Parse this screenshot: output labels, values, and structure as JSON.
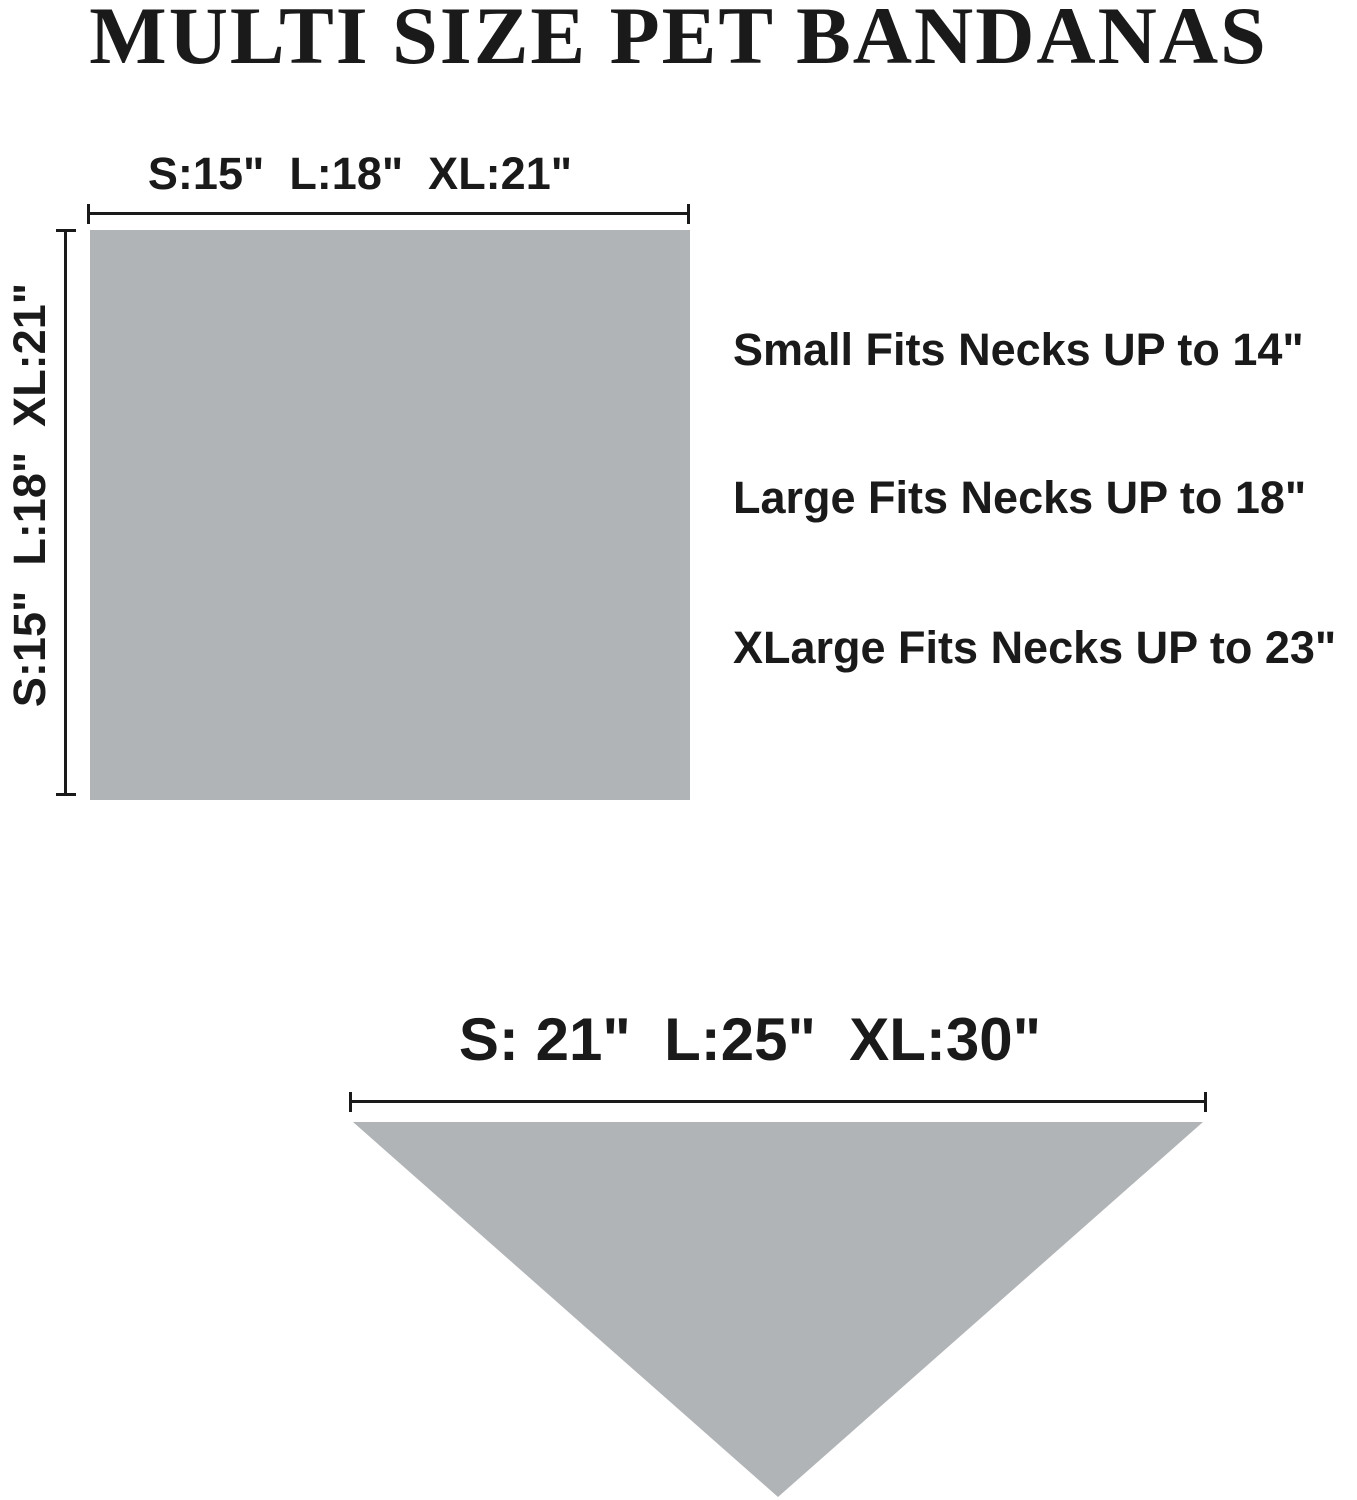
{
  "title": "MULTI SIZE PET BANDANAS",
  "colors": {
    "ink": "#1a1a1a",
    "bandana_gray": "#b1b4b6",
    "background": "#ffffff"
  },
  "square_diagram": {
    "width_label": "S:15\"  L:18\"  XL:21\"",
    "height_label": "S:15\"  L:18\"  XL:21\"",
    "fit_notes": [
      "Small Fits Necks UP to 14\"",
      "Large Fits Necks UP to 18\"",
      "XLarge Fits Necks UP to 23\""
    ]
  },
  "triangle_diagram": {
    "width_label": "S: 21\"  L:25\"  XL:30\""
  }
}
